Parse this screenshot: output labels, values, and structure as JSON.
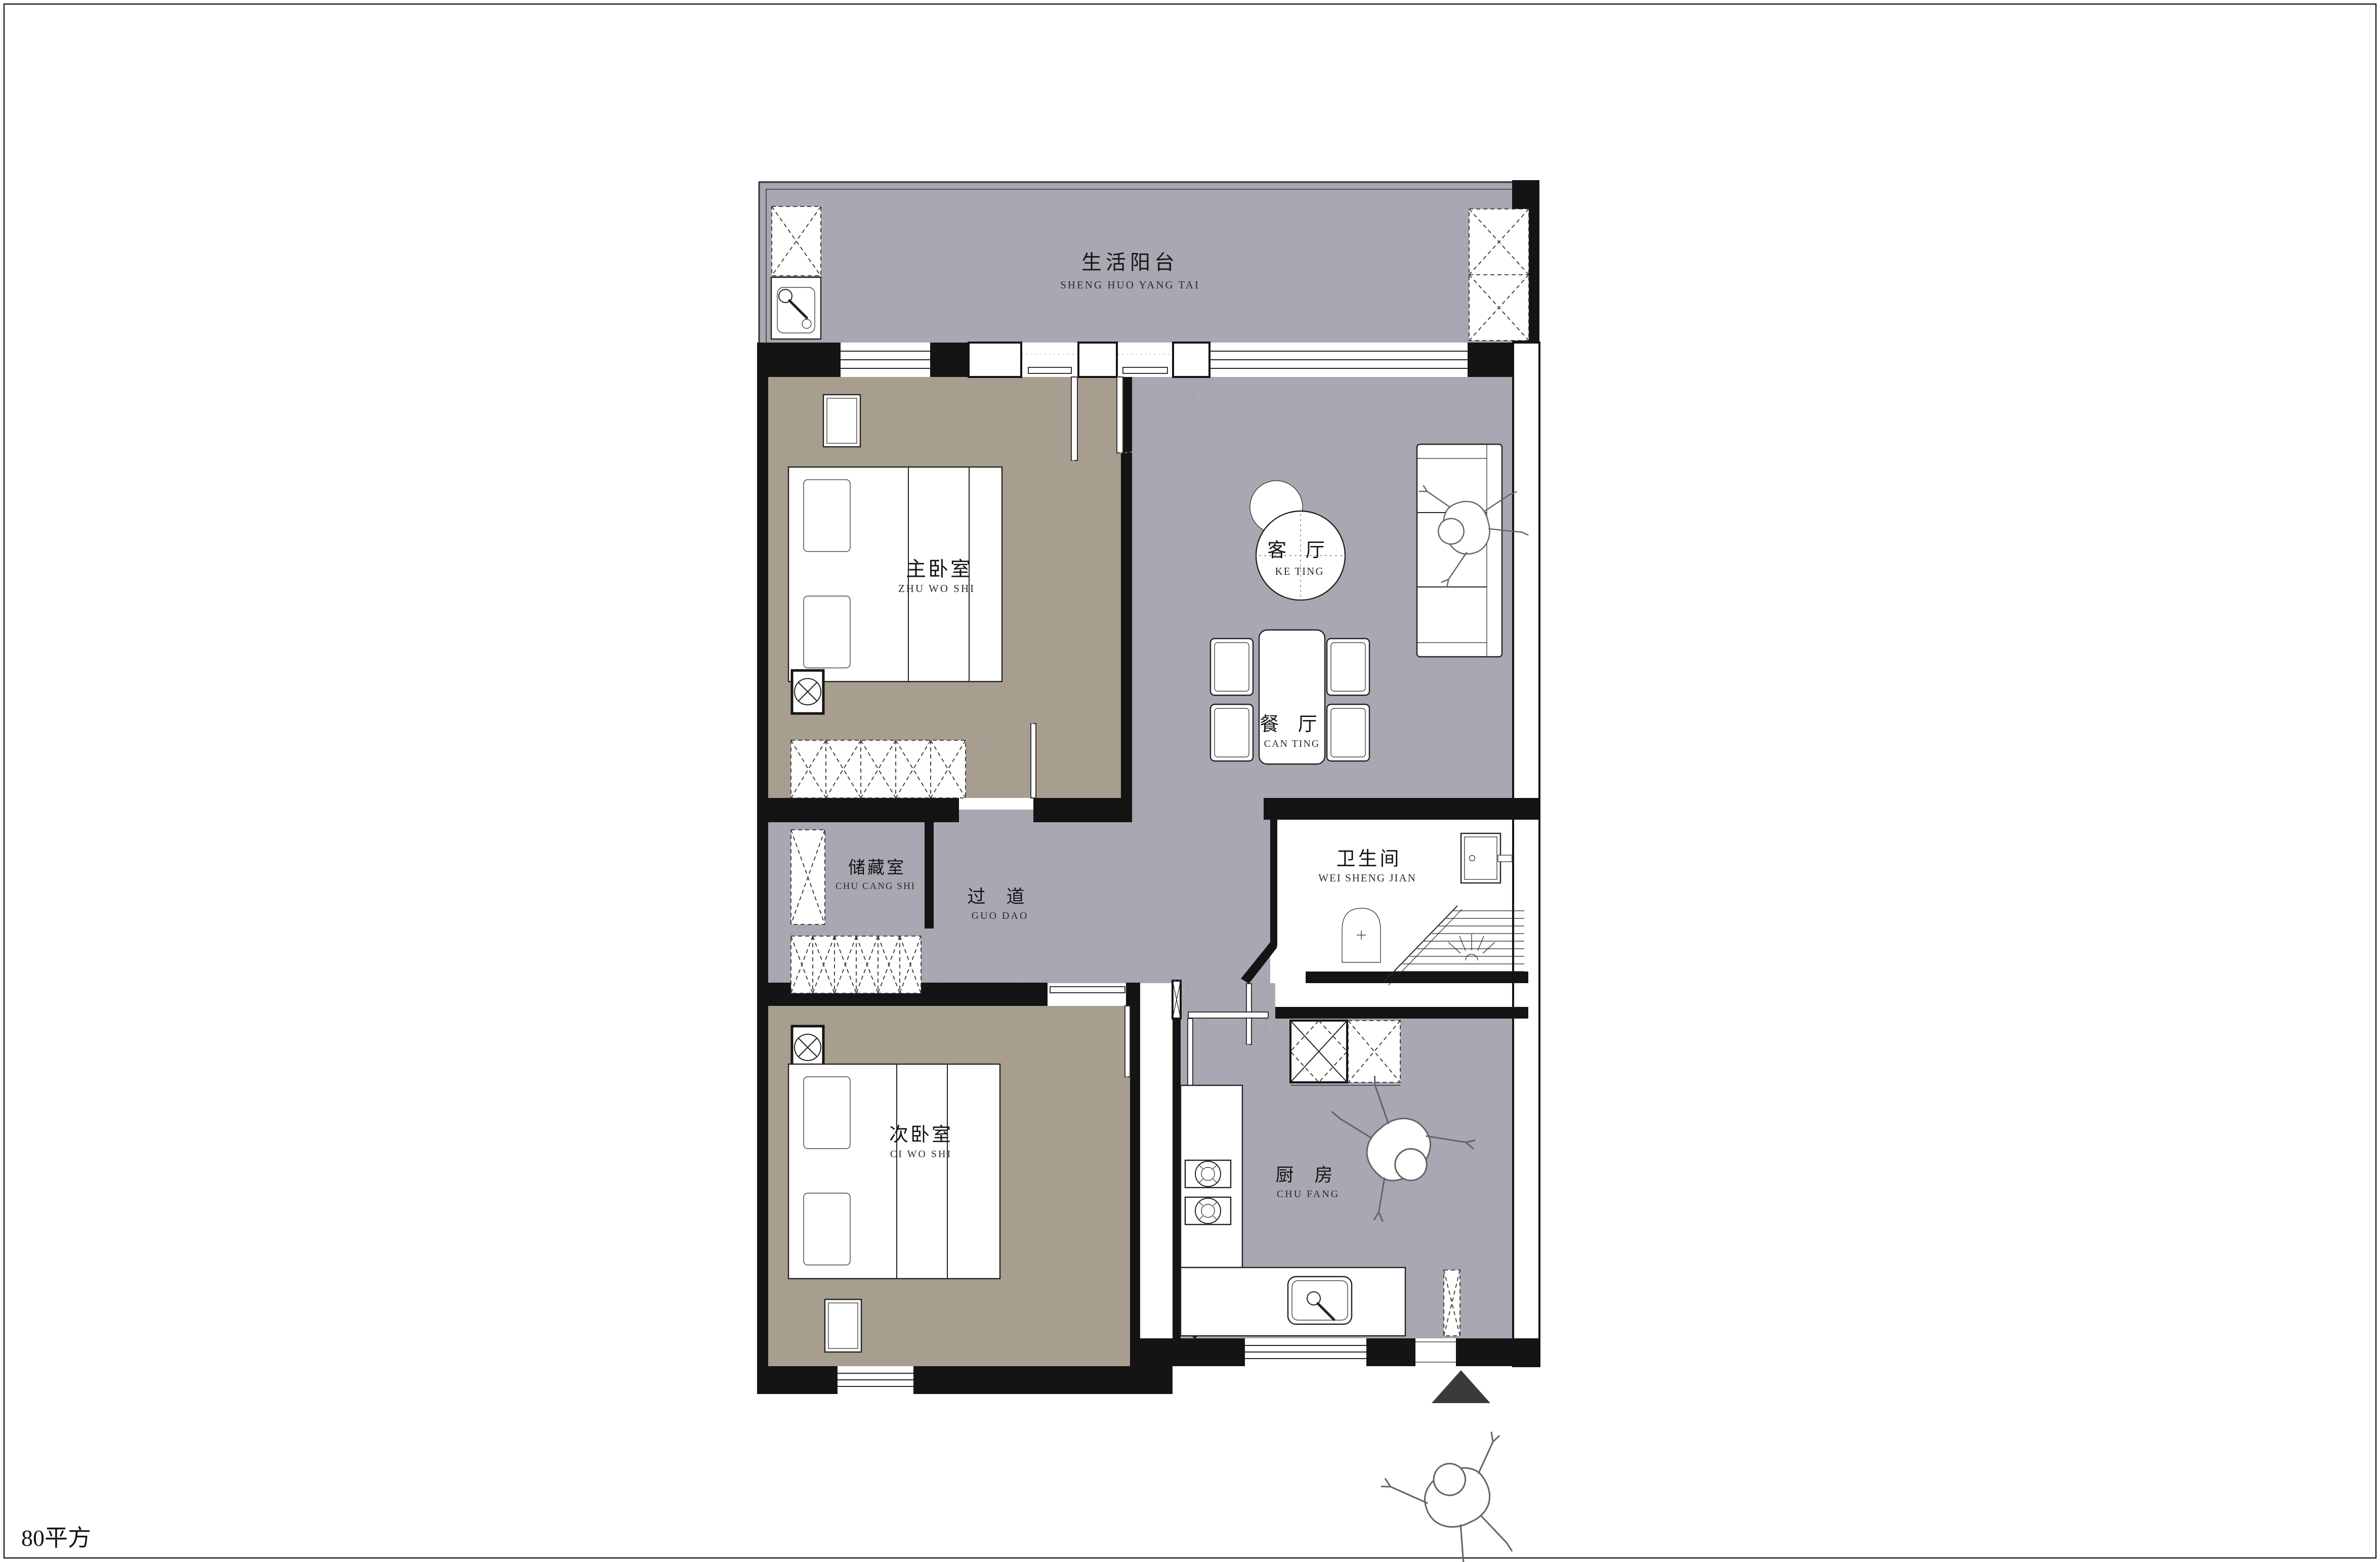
{
  "page": {
    "area_label": "80平方",
    "border_color": "#222222",
    "background": "#ffffff"
  },
  "colors": {
    "public_floor_gray": "#a8a8b2",
    "bedroom_floor_taupe": "#a89e90",
    "wall_black": "#141414",
    "entry_arrow": "#3a3a3a",
    "furniture_line": "#222222"
  },
  "rooms": {
    "balcony": {
      "zh": "生活阳台",
      "pinyin": "SHENG HUO YANG TAI"
    },
    "master_bedroom": {
      "zh": "主卧室",
      "pinyin": "ZHU WO SHI"
    },
    "living_room": {
      "zh": "客 厅",
      "pinyin": "KE TING"
    },
    "dining_room": {
      "zh": "餐 厅",
      "pinyin": "CAN TING"
    },
    "storage_room": {
      "zh": "储藏室",
      "pinyin": "CHU CANG SHI"
    },
    "corridor": {
      "zh": "过 道",
      "pinyin": "GUO DAO"
    },
    "bathroom": {
      "zh": "卫生间",
      "pinyin": "WEI SHENG JIAN"
    },
    "second_bedroom": {
      "zh": "次卧室",
      "pinyin": "CI WO SHI"
    },
    "kitchen": {
      "zh": "厨 房",
      "pinyin": "CHU FANG"
    }
  }
}
